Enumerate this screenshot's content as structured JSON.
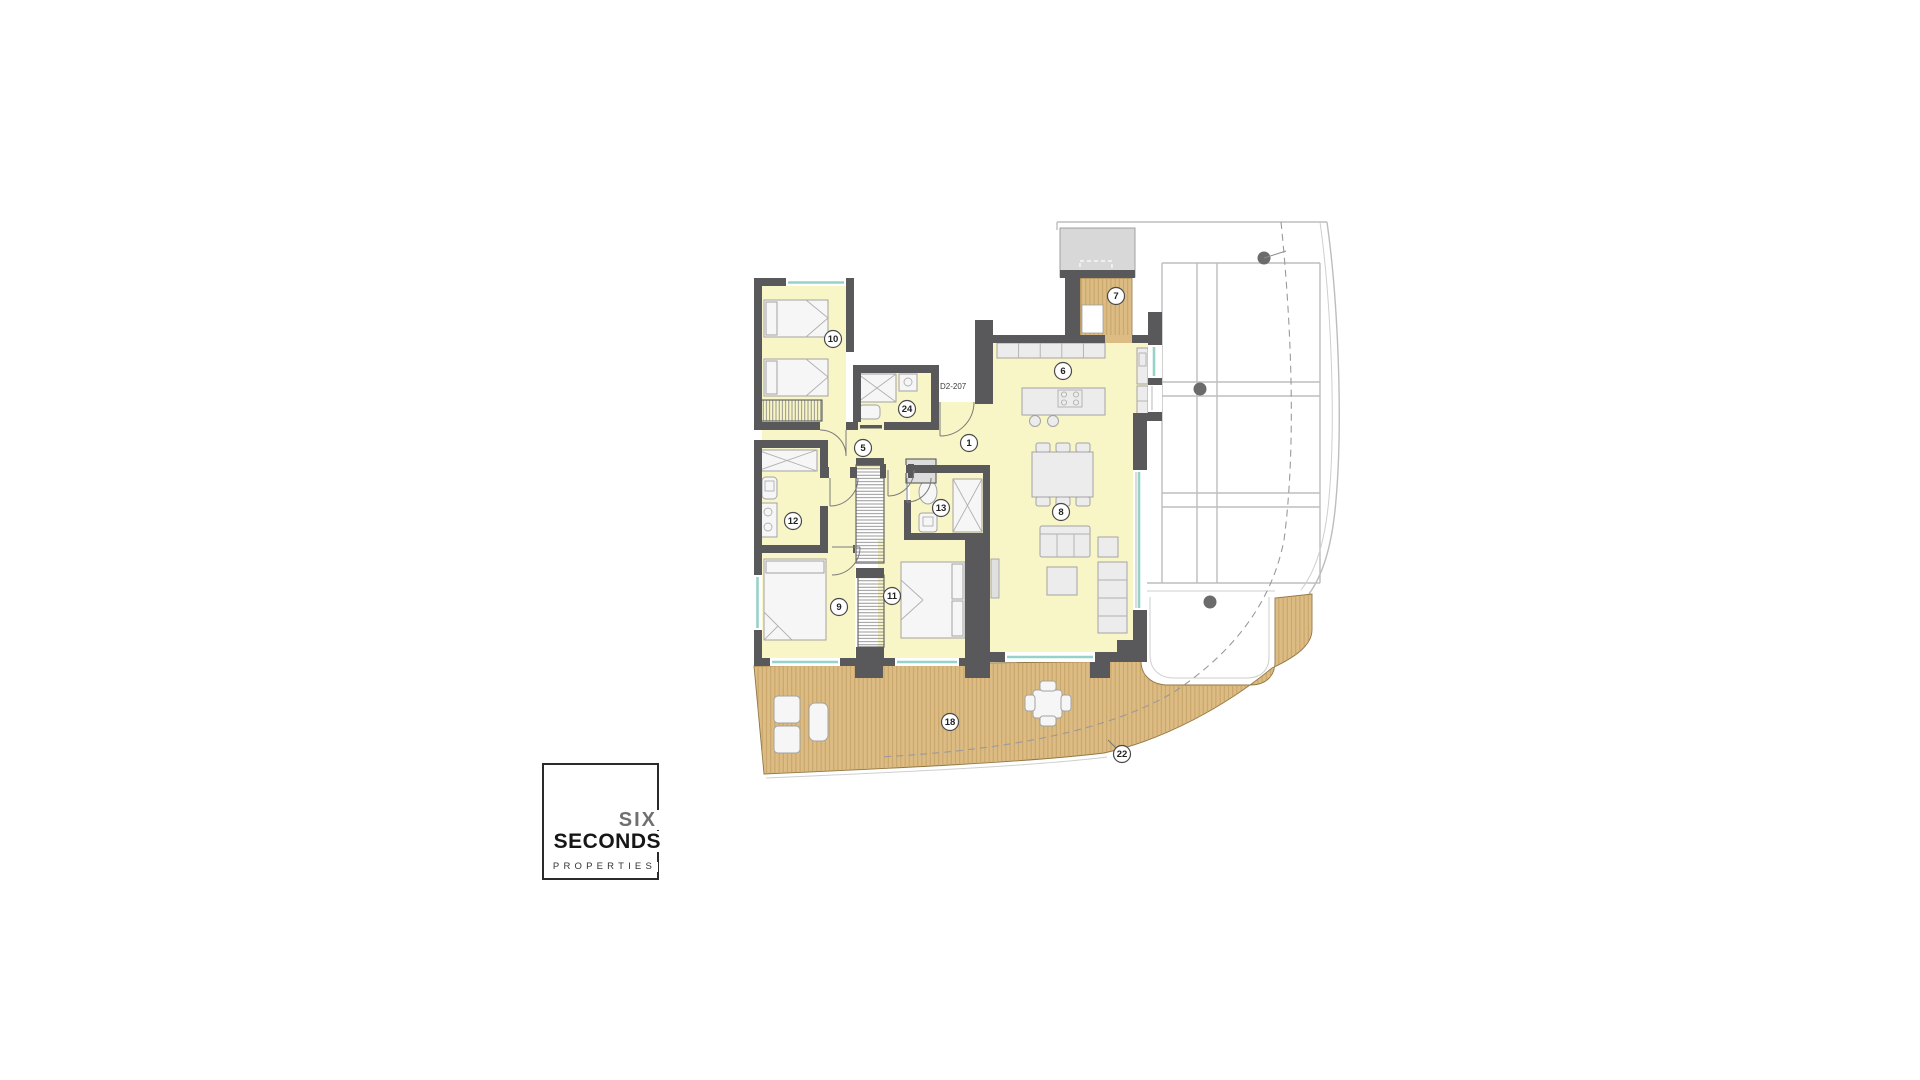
{
  "unit_label": "D2-207",
  "logo": {
    "line1": "SIX",
    "line2": "SECONDS",
    "line3": "PROPERTIES"
  },
  "rooms": {
    "entry_hall": "1",
    "hallway": "5",
    "kitchen": "6",
    "drying_deck": "7",
    "living_dining": "8",
    "bedroom_2": "9",
    "bedroom_1": "10",
    "bedroom_3": "11",
    "bathroom_2": "12",
    "bathroom_3": "13",
    "bathroom_1": "24",
    "terrace": "18",
    "terrace_perimeter": "22"
  },
  "colors": {
    "background": "#ffffff",
    "wall": "#59595b",
    "floor": "#f8f5c6",
    "deck": "#dcbc82",
    "deck_line": "#bb9a5f",
    "window_glass": "#96d2c9",
    "furniture_fill": "#ececec",
    "furniture_stroke": "#a3a3a3",
    "outline_line": "#bdbdbd",
    "column_dot": "#6b6b6b",
    "roof_block": "#d8d8d8",
    "dashed_line": "#9a9a9a",
    "label_stroke": "#4a4a4a",
    "logo_six": "#6f6f6f",
    "logo_text": "#161616"
  }
}
